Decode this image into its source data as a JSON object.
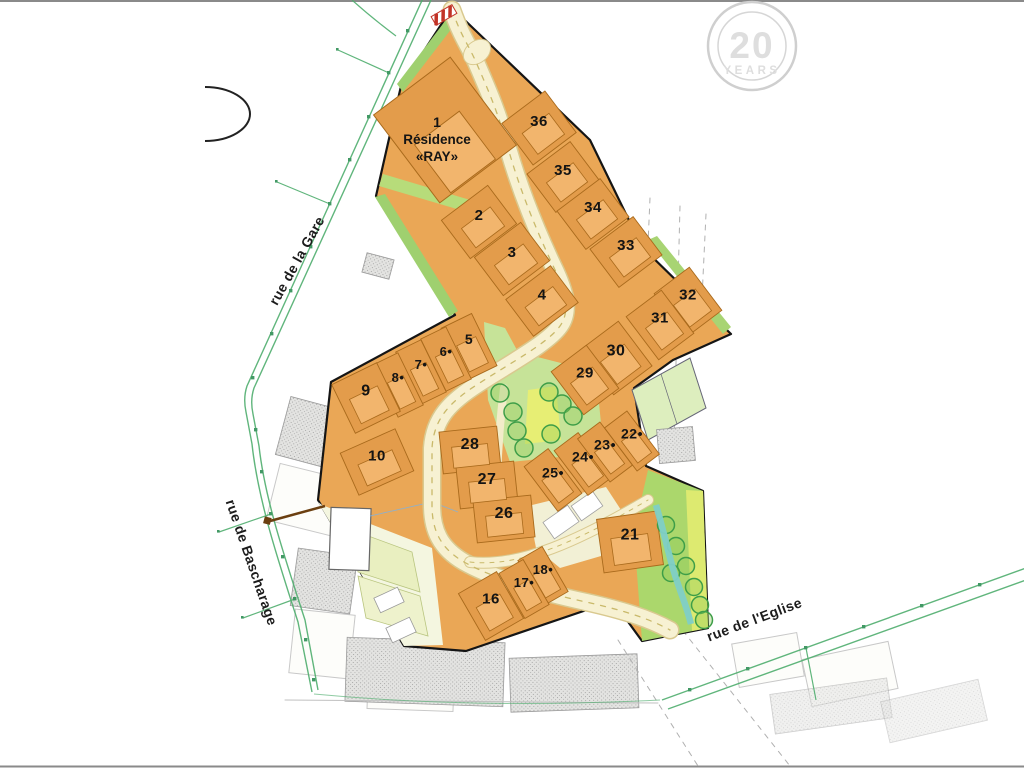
{
  "title": "Lotissement site plan",
  "watermark": {
    "number": "20",
    "label": "YEARS"
  },
  "residence": {
    "lot_number": "1",
    "name_line1": "Résidence",
    "name_line2": "«RAY»"
  },
  "streets": [
    {
      "name": "rue de la Gare",
      "x": 301,
      "y": 263,
      "rotation": -61
    },
    {
      "name": "rue de Bascharage",
      "x": 247,
      "y": 564,
      "rotation": 71
    },
    {
      "name": "rue de l'Eglise",
      "x": 756,
      "y": 624,
      "rotation": -20.5
    }
  ],
  "lots": [
    {
      "label": "2",
      "x": 479,
      "y": 222,
      "angle": -37,
      "pw": 58,
      "ph": 48,
      "fs": 15
    },
    {
      "label": "3",
      "x": 512,
      "y": 259,
      "angle": -37,
      "pw": 58,
      "ph": 48,
      "fs": 15
    },
    {
      "label": "4",
      "x": 542,
      "y": 301,
      "angle": -37,
      "pw": 56,
      "ph": 46,
      "fs": 15
    },
    {
      "label": "36",
      "x": 539,
      "y": 128,
      "angle": -37,
      "pw": 54,
      "ph": 52,
      "fs": 15
    },
    {
      "label": "35",
      "x": 563,
      "y": 177,
      "angle": -37,
      "pw": 54,
      "ph": 48,
      "fs": 15
    },
    {
      "label": "34",
      "x": 593,
      "y": 214,
      "angle": -37,
      "pw": 54,
      "ph": 48,
      "fs": 15
    },
    {
      "label": "33",
      "x": 626,
      "y": 252,
      "angle": -37,
      "pw": 54,
      "ph": 48,
      "fs": 15
    },
    {
      "label": "32",
      "x": 688,
      "y": 302,
      "angle": -37,
      "pw": 44,
      "ph": 54,
      "fs": 15
    },
    {
      "label": "31",
      "x": 660,
      "y": 325,
      "angle": -37,
      "pw": 44,
      "ph": 54,
      "fs": 15
    },
    {
      "label": "30",
      "x": 616,
      "y": 358,
      "angle": -37,
      "pw": 48,
      "ph": 56,
      "fs": 16
    },
    {
      "label": "29",
      "x": 585,
      "y": 380,
      "angle": -37,
      "pw": 44,
      "ph": 54,
      "fs": 15
    },
    {
      "label": "5",
      "x": 469,
      "y": 347,
      "angle": -26,
      "pw": 34,
      "ph": 58,
      "fs": 14
    },
    {
      "label": "6•",
      "x": 446,
      "y": 359,
      "angle": -26,
      "pw": 28,
      "ph": 58,
      "fs": 13
    },
    {
      "label": "7•",
      "x": 421,
      "y": 372,
      "angle": -26,
      "pw": 28,
      "ph": 58,
      "fs": 13
    },
    {
      "label": "8•",
      "x": 398,
      "y": 385,
      "angle": -26,
      "pw": 28,
      "ph": 58,
      "fs": 13
    },
    {
      "label": "9",
      "x": 366,
      "y": 398,
      "angle": -26,
      "pw": 50,
      "ph": 54,
      "fs": 16
    },
    {
      "label": "10",
      "x": 377,
      "y": 462,
      "angle": -24,
      "pw": 60,
      "ph": 46,
      "fs": 15
    },
    {
      "label": "28",
      "x": 470,
      "y": 450,
      "angle": -6,
      "pw": 58,
      "ph": 42,
      "fs": 16
    },
    {
      "label": "27",
      "x": 487,
      "y": 485,
      "angle": -6,
      "pw": 58,
      "ph": 42,
      "fs": 16
    },
    {
      "label": "26",
      "x": 504,
      "y": 519,
      "angle": -6,
      "pw": 58,
      "ph": 42,
      "fs": 16
    },
    {
      "label": "25•",
      "x": 553,
      "y": 480,
      "angle": -37,
      "pw": 30,
      "ph": 56,
      "fs": 14
    },
    {
      "label": "24•",
      "x": 583,
      "y": 464,
      "angle": -37,
      "pw": 30,
      "ph": 56,
      "fs": 14
    },
    {
      "label": "23•",
      "x": 605,
      "y": 452,
      "angle": -37,
      "pw": 28,
      "ph": 54,
      "fs": 14
    },
    {
      "label": "22•",
      "x": 632,
      "y": 441,
      "angle": -37,
      "pw": 28,
      "ph": 54,
      "fs": 14
    },
    {
      "label": "21",
      "x": 630,
      "y": 542,
      "angle": -8,
      "pw": 60,
      "ph": 54,
      "fs": 16
    },
    {
      "label": "18•",
      "x": 543,
      "y": 576,
      "angle": -30,
      "pw": 28,
      "ph": 52,
      "fs": 13
    },
    {
      "label": "17•",
      "x": 524,
      "y": 589,
      "angle": -30,
      "pw": 28,
      "ph": 52,
      "fs": 13
    },
    {
      "label": "16",
      "x": 491,
      "y": 606,
      "angle": -30,
      "pw": 44,
      "ph": 54,
      "fs": 15
    }
  ],
  "colors": {
    "site_orange": "#eaa756",
    "parcel_orange": "#e39c4b",
    "building_orange": "#f2b56d",
    "lot_border": "#a96a1c",
    "road_fill": "#f7f1d2",
    "road_edge": "#d9c98f",
    "green_strip": "#9fd06f",
    "park_green": "#c6e398",
    "play_yellow": "#e7ee74",
    "corridor_green": "#abd76c",
    "stream_cyan": "#7fcfc7",
    "boundary_black": "#151515",
    "street_green": "#4fae6e",
    "watermark_gray": "#d4d4d4",
    "barrier_red": "#c23327"
  }
}
